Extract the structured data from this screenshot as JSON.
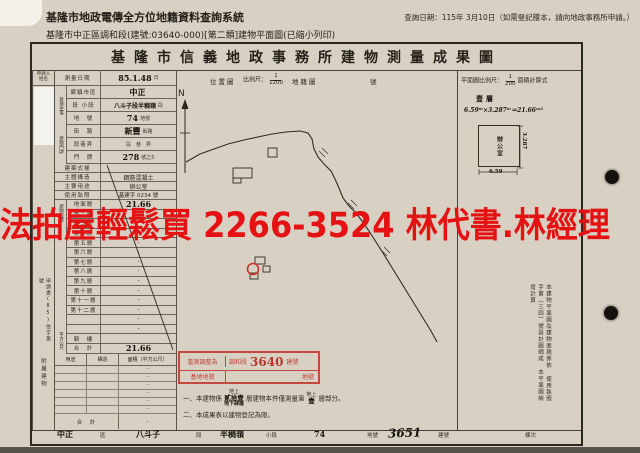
{
  "header": {
    "system_title": "基隆市地政電傳全方位地籍資料查詢系統",
    "query_date": "查詢日期：115年 3月10日（如需登記謄本，請向地政事務所申請。）",
    "subtitle": "基隆市中正區調和段(建號:03640-000)[第二類]建物平面圖(已縮小列印)"
  },
  "doc": {
    "title": "基隆市信義地政事務所建物測量成果圖",
    "location_header": {
      "label": "位置圖",
      "scale_prefix": "比例尺：",
      "scale_num": "1",
      "scale_den": "1200",
      "cadastral": "地籍圖",
      "suffix": "號"
    },
    "plan_header": {
      "label": "平面圖比例尺：",
      "scale_num": "1",
      "scale_den": "200",
      "calc_label": "面積計算式"
    },
    "compass": "N"
  },
  "applicant": {
    "line1": "申請人",
    "line2": "姓名"
  },
  "survey": {
    "label": "測量日期",
    "value": "85.1.48",
    "suffix": "日"
  },
  "site": {
    "group": "基地坐落",
    "rows": [
      {
        "label": "鄉鎮市區",
        "value": "中正",
        "suffix": ""
      },
      {
        "label": "段 小段",
        "value": "八斗子段半稠嶺",
        "suffix": "段"
      },
      {
        "label": "地　號",
        "value": "74",
        "suffix": "地號"
      }
    ]
  },
  "address": {
    "group": "建物門牌",
    "rows": [
      {
        "label": "街　路",
        "value": "新豐",
        "suffix": "街路"
      },
      {
        "label": "段巷弄",
        "value": "",
        "suffix": "段　巷　弄"
      },
      {
        "label": "門　牌",
        "value": "278",
        "suffix": "號之5"
      }
    ]
  },
  "attrs": [
    {
      "label": "建築式樣",
      "value": ""
    },
    {
      "label": "主體構造",
      "value": "鋼筋混凝土"
    },
    {
      "label": "主要用途",
      "value": "辦公室"
    },
    {
      "label": "使用執照",
      "value": "基建字 0234 號"
    }
  ],
  "area": {
    "group_label": "建物面積",
    "unit_label": "平方公尺",
    "floors": [
      {
        "label": "地面層",
        "value": "21.66"
      },
      {
        "label": "第二層",
        "value": "·"
      },
      {
        "label": "第三層",
        "value": "·"
      },
      {
        "label": "第四層",
        "value": "·"
      },
      {
        "label": "第五層",
        "value": "·"
      },
      {
        "label": "第六層",
        "value": "·"
      },
      {
        "label": "第七層",
        "value": "·"
      },
      {
        "label": "第八層",
        "value": "·"
      },
      {
        "label": "第九層",
        "value": "·"
      },
      {
        "label": "第十層",
        "value": "·"
      },
      {
        "label": "第十一層",
        "value": "·"
      },
      {
        "label": "第十二層",
        "value": "·"
      },
      {
        "label": "",
        "value": "·"
      },
      {
        "label": "",
        "value": "·"
      },
      {
        "label": "騎　樓",
        "value": ""
      },
      {
        "label": "合　計",
        "value": "21.66"
      }
    ]
  },
  "annex": {
    "group_label": "附屬建物",
    "headers": [
      "用途",
      "構造",
      "面積（平方公尺）"
    ],
    "rows": [
      "·",
      "·",
      "·",
      "·",
      "·",
      "·"
    ],
    "total_label": "合　計",
    "total_value": "·"
  },
  "margin_note": "申請書(85)信字第　號",
  "stamp": {
    "left_top": "重測調整為",
    "left_bottom": "基地地號",
    "section": "調和段",
    "number": "3640",
    "unit_top": "建號",
    "unit_bottom": "地號"
  },
  "notes": {
    "n1_prefix": "一、本建物係",
    "n1_above": "地上",
    "n1_value": "貳拾壹",
    "n1_below": "地下肆層",
    "n1_middle": "層建物本件僅測量第",
    "n2_above": "地上",
    "n2_value": "壹",
    "n1_suffix": "層部分。",
    "n2": "二、本成果表以建物登記為限。"
  },
  "plan": {
    "floor_label": "壹層",
    "formula": "6.59ᵐ×3.287ᵐ＝21.66ᵐ²",
    "room_label": "辦公室",
    "width_dim": "6.59",
    "height_dim": "3.287"
  },
  "side_notes": [
    "本建物平面圖及建物面積係依",
    "使用執照字第（三四）號設計圖晒成",
    "本平面圖繪增計算"
  ],
  "footer": {
    "cells": [
      {
        "text": "中正"
      },
      {
        "text": "區"
      },
      {
        "text": "八斗子"
      },
      {
        "text": "段"
      },
      {
        "text": "半稠嶺"
      },
      {
        "text": "小段"
      },
      {
        "text": "74"
      },
      {
        "text": "地號"
      },
      {
        "text": "3651"
      },
      {
        "text": "建號"
      },
      {
        "text": "棟次"
      }
    ]
  },
  "watermark": "法拍屋輕鬆買  2266-3524  林代書.林經理",
  "colors": {
    "paper": "#d8d1c3",
    "ink": "#2b251e",
    "stamp_red": "#c4483b",
    "watermark_red": "#e41212"
  }
}
